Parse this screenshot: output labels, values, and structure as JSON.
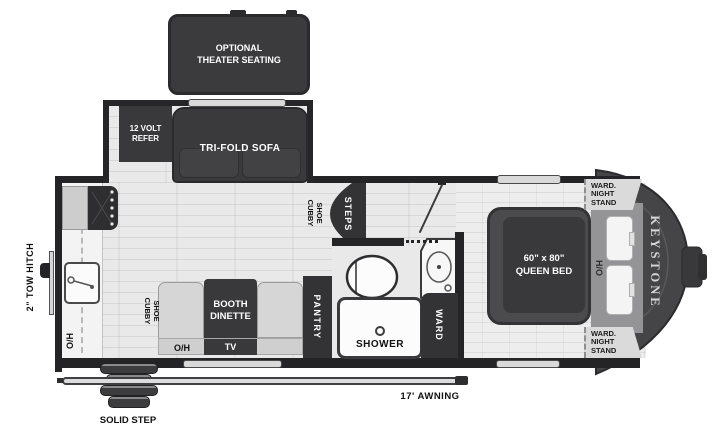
{
  "page": {
    "background": "#ffffff",
    "description": "Keystone travel trailer floor plan"
  },
  "exterior": {
    "tow_hitch_label": "2\" TOW HITCH",
    "solid_step_label": "SOLID STEP",
    "awning_label": "17' AWNING",
    "brand_vertical": "KEYSTONE"
  },
  "optional": {
    "theater_seating_label": "OPTIONAL THEATER SEATING"
  },
  "slide_out": {
    "refer_label": "12 VOLT REFER",
    "sofa_label": "TRI-FOLD SOFA"
  },
  "kitchen": {
    "overhead_label": "O/H"
  },
  "entry": {
    "shoe_cubby_label": "SHOE CUBBY",
    "steps_label": "STEPS"
  },
  "dinette": {
    "shoe_cubby_label": "SHOE CUBBY",
    "booth_label": "BOOTH DINETTE",
    "overhead_label": "O/H",
    "tv_label": "TV"
  },
  "bath": {
    "pantry_label": "PANTRY",
    "shower_label": "SHOWER",
    "ward_label": "WARD"
  },
  "bedroom": {
    "bed_size": "60\" x 80\"",
    "bed_type": "QUEEN BED",
    "hamper_overhead_label": "H/O",
    "ward_night_stand_top": "WARD. NIGHT STAND",
    "ward_night_stand_bottom": "WARD. NIGHT STAND"
  },
  "colors": {
    "wall": "#242426",
    "furniture_dark": "#39393b",
    "floor": "#e9e9e9",
    "counter": "#f3f3f3",
    "bed_base_gray": "#949496",
    "front_cap": "#454547"
  }
}
